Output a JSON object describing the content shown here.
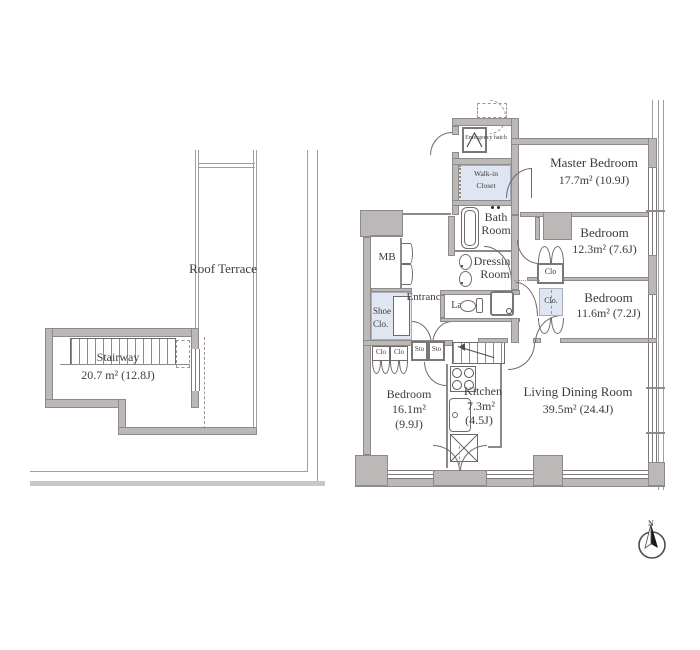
{
  "plan": {
    "terrace": {
      "label": "Roof Terrace"
    },
    "stairway": {
      "name": "Stairway",
      "area": "20.7 m² (12.8J)"
    },
    "master_bedroom": {
      "name": "Master Bedroom",
      "area": "17.7m² (10.9J)"
    },
    "bedroom2": {
      "name": "Bedroom",
      "area": "12.3m² (7.6J)"
    },
    "bedroom3": {
      "name": "Bedroom",
      "area": "11.6m² (7.2J)"
    },
    "living": {
      "name": "Living Dining Room",
      "area": "39.5m² (24.4J)"
    },
    "bedroom4": {
      "name": "Bedroom",
      "area_line1": "16.1m²",
      "area_line2": "(9.9J)"
    },
    "kitchen": {
      "name": "Kitchen",
      "area_line1": "7.3m²",
      "area_line2": "(4.5J)"
    },
    "bath": {
      "name_line1": "Bath",
      "name_line2": "Room"
    },
    "dressing": {
      "name_line1": "Dressing",
      "name_line2": "Room"
    },
    "walkin": {
      "name_line1": "Walk-in",
      "name_line2": "Closet"
    },
    "entrance": {
      "name": "Entrance"
    },
    "shoe": {
      "name_line1": "Shoe",
      "name_line2": "Clo."
    },
    "mb": {
      "name": "MB"
    },
    "lav": {
      "name": "Lav"
    },
    "emergency": {
      "name": "Emergency hatch"
    },
    "clo_b12": "Clo",
    "clo_b11": "Clo.",
    "sto1": "Sto",
    "sto2": "Sto",
    "clo_b4_1": "Clo",
    "clo_b4_2": "Clo",
    "compass": {
      "label": "N"
    }
  },
  "colors": {
    "wall_fill": "#bcb8b8",
    "wall_edge": "#8e8a8a",
    "closet_fill": "#dfe6f2",
    "line": "#6e6a6a",
    "text": "#42393d"
  }
}
